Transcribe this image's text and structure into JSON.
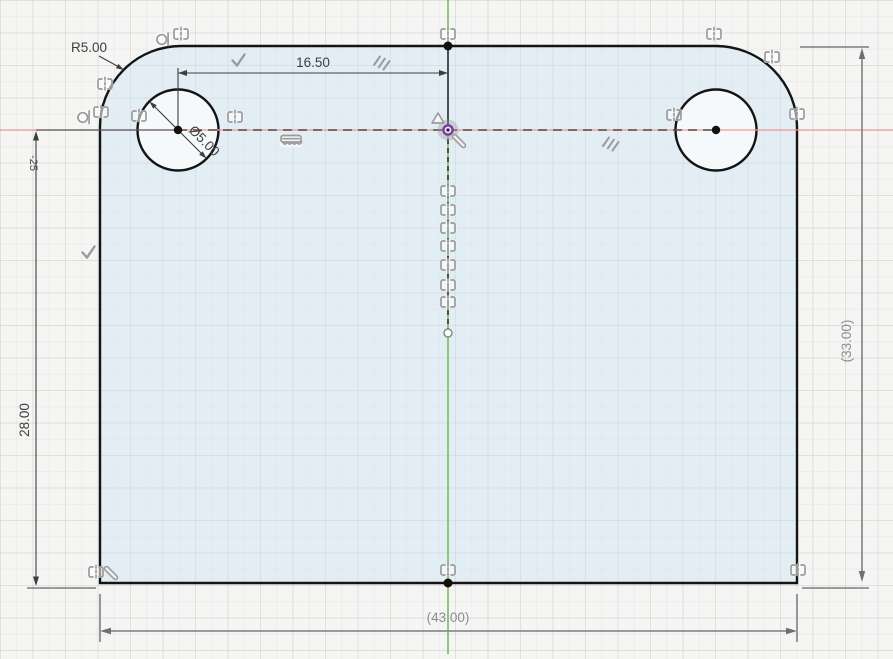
{
  "canvas": {
    "width": 893,
    "height": 654
  },
  "dimensions": {
    "fillet_radius": "R5.00",
    "hole_spacing": "16.50",
    "hole_diameter": "Ø5.00",
    "center_to_bottom_height": "28.00",
    "partial_left_label": "-25",
    "overall_height_ref": "(33.00)",
    "overall_width_ref": "(43.00)"
  },
  "colors": {
    "x_axis": "#f09a9a",
    "y_axis": "#74b94e",
    "construction_line": "#5c4742",
    "profile_stroke": "#141414",
    "profile_fill": "#d6e8f6",
    "hole_fill": "#f9fafb",
    "dimension": "#3e3e3e",
    "reference_dimension": "#8d8d8d",
    "constraint_icon": "#9b9b9b",
    "origin_point": "#7b3aa5"
  },
  "constraints": [
    {
      "type": "tangent",
      "x": 163,
      "y": 39
    },
    {
      "type": "symmetry",
      "x": 181,
      "y": 34
    },
    {
      "type": "symmetry",
      "x": 448,
      "y": 34
    },
    {
      "type": "symmetry",
      "x": 714,
      "y": 34
    },
    {
      "type": "symmetry",
      "x": 772,
      "y": 57
    },
    {
      "type": "perpendicular",
      "x": 238,
      "y": 60
    },
    {
      "type": "parallel",
      "x": 381,
      "y": 62
    },
    {
      "type": "symmetry",
      "x": 105,
      "y": 84
    },
    {
      "type": "tangent",
      "x": 84,
      "y": 117
    },
    {
      "type": "symmetry",
      "x": 101,
      "y": 112
    },
    {
      "type": "symmetry",
      "x": 139,
      "y": 116
    },
    {
      "type": "symmetry",
      "x": 235,
      "y": 117
    },
    {
      "type": "smooth",
      "x": 291,
      "y": 141
    },
    {
      "type": "midpoint",
      "x": 438,
      "y": 118
    },
    {
      "type": "pin",
      "x": 459,
      "y": 141
    },
    {
      "type": "parallel",
      "x": 610,
      "y": 143
    },
    {
      "type": "perpendicular",
      "x": 88,
      "y": 252
    },
    {
      "type": "symmetry",
      "x": 674,
      "y": 115
    },
    {
      "type": "symmetry",
      "x": 797,
      "y": 114
    },
    {
      "type": "symmetry",
      "x": 448,
      "y": 191
    },
    {
      "type": "symmetry",
      "x": 448,
      "y": 210
    },
    {
      "type": "symmetry",
      "x": 448,
      "y": 228
    },
    {
      "type": "symmetry",
      "x": 448,
      "y": 246
    },
    {
      "type": "symmetry",
      "x": 448,
      "y": 265
    },
    {
      "type": "symmetry",
      "x": 448,
      "y": 285
    },
    {
      "type": "symmetry",
      "x": 448,
      "y": 302
    },
    {
      "type": "symmetry",
      "x": 96,
      "y": 572
    },
    {
      "type": "pin",
      "x": 111,
      "y": 573
    },
    {
      "type": "symmetry",
      "x": 448,
      "y": 570
    },
    {
      "type": "symmetry",
      "x": 798,
      "y": 570
    }
  ]
}
